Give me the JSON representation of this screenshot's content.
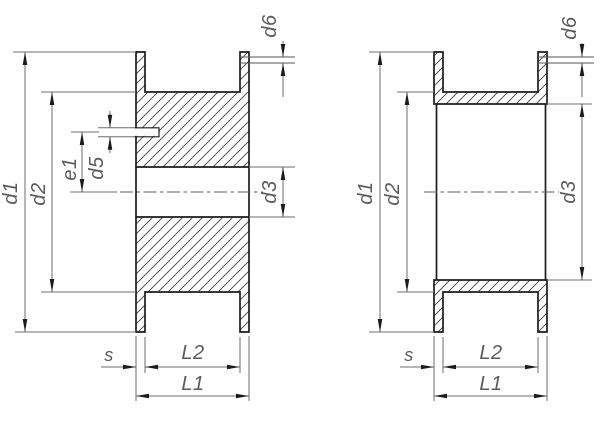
{
  "drawing": {
    "colors": {
      "background": "#ffffff",
      "part_outline": "#1c1c1c",
      "hatch_lines": "#3f3f3f",
      "dimension_lines": "#6e6e6e",
      "label_text": "#5a5a5a",
      "arrowhead": "#1c1c1c"
    },
    "left_view": {
      "labels": {
        "d1": "d1",
        "d2": "d2",
        "e1": "e1",
        "d5": "d5",
        "d6": "d6",
        "d3": "d3",
        "s": "s",
        "L2": "L2",
        "L1": "L1"
      }
    },
    "right_view": {
      "labels": {
        "d1": "d1",
        "d2": "d2",
        "d6": "d6",
        "d3": "d3",
        "s": "s",
        "L2": "L2",
        "L1": "L1"
      }
    }
  }
}
